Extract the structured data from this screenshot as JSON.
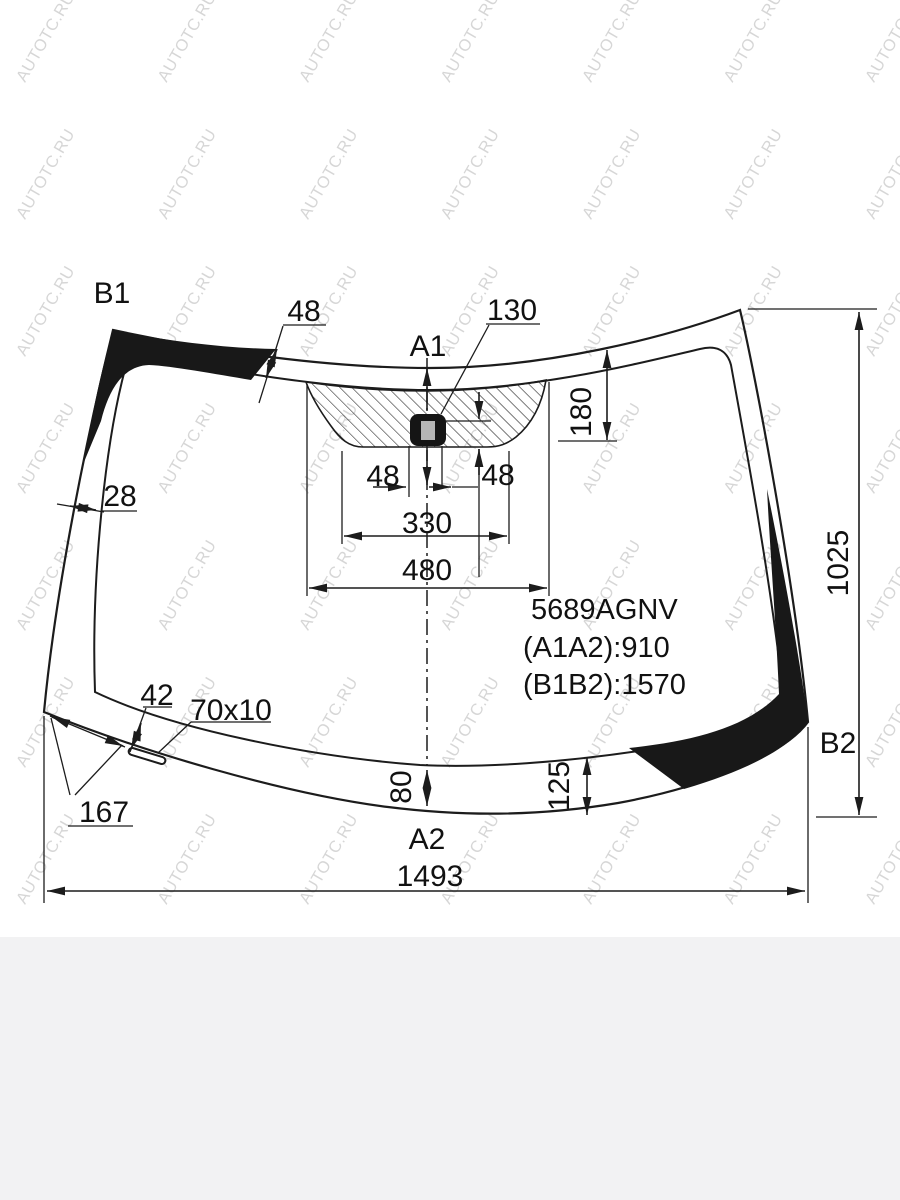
{
  "title": "Windshield glass dimensions drawing",
  "watermark": {
    "text": "AUTOTC.RU"
  },
  "part_info": {
    "code": "5689AGNV",
    "a1a2": "(A1A2):910",
    "b1b2": "(B1B2):1570"
  },
  "points": {
    "a1": "A1",
    "a2": "A2",
    "b1": "B1",
    "b2": "B2"
  },
  "dims": {
    "top_band_width": "48",
    "mount_offset": "130",
    "camera_zone_height": "180",
    "mount_left": "48",
    "mount_right": "48",
    "camera_zone_bottom_width": "330",
    "camera_zone_top_width": "480",
    "left_band_width": "28",
    "slot_edge_offset": "42",
    "slot_size": "70x10",
    "corner_band_length": "167",
    "bottom_center_band": "80",
    "bottom_right_band": "125",
    "glass_height": "1025",
    "glass_width": "1493"
  },
  "colors": {
    "line": "#1c1c1c",
    "black_band": "#181818",
    "mount_gray": "#b5b5b5",
    "footer_bg": "#f2f2f3",
    "watermark": "#8a8a8a"
  }
}
